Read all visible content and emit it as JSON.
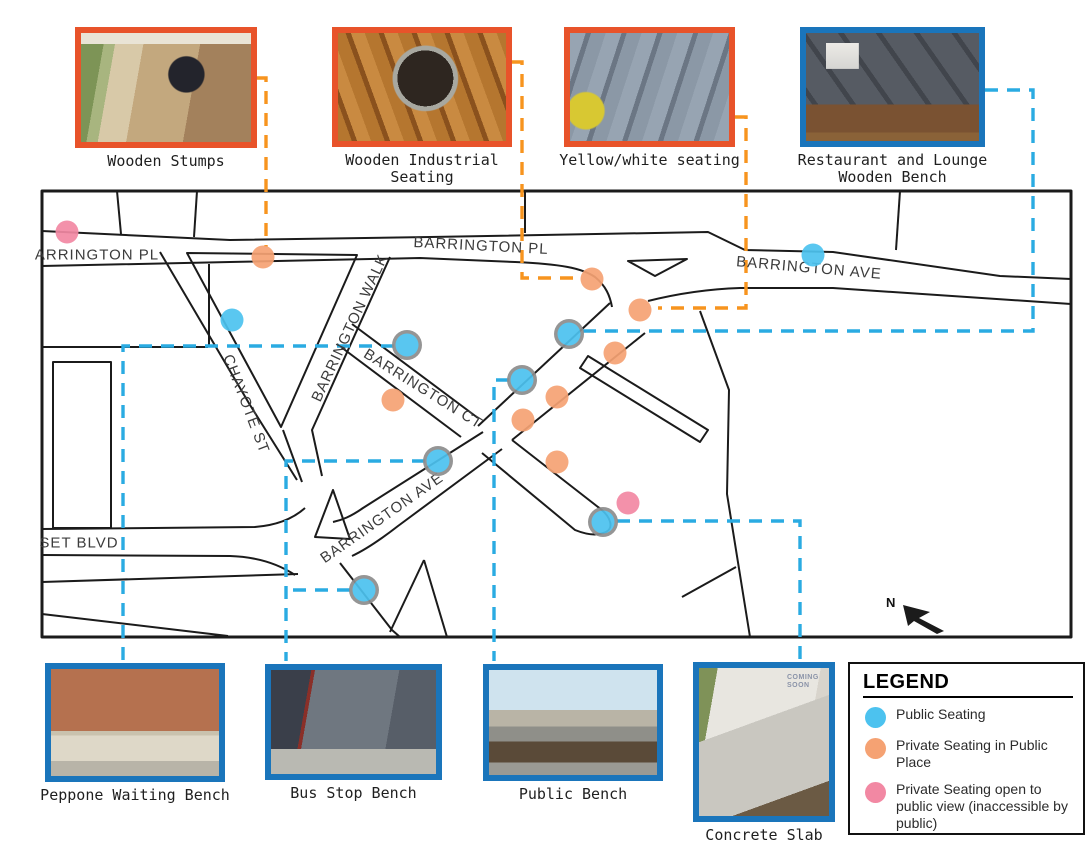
{
  "colors": {
    "road": "#1b1b1b",
    "ring": "#8d8d8d",
    "dash_orange": "#f7941e",
    "dash_blue": "#2aabe2",
    "frame_orange": "#e8532a",
    "frame_blue": "#1a75bb",
    "dot_blue": "#4cc2ef",
    "dot_orange": "#f5a273",
    "dot_pink": "#f288a3"
  },
  "top_photos": [
    {
      "label": "Wooden Stumps",
      "border": "orange"
    },
    {
      "label": "Wooden Industrial Seating",
      "border": "orange"
    },
    {
      "label": "Yellow/white seating",
      "border": "orange"
    },
    {
      "label": "Restaurant and Lounge Wooden Bench",
      "border": "blue"
    }
  ],
  "bottom_photos": [
    {
      "label": "Peppone Waiting Bench",
      "border": "blue"
    },
    {
      "label": "Bus Stop Bench",
      "border": "blue"
    },
    {
      "label": "Public Bench",
      "border": "blue"
    },
    {
      "label": "Concrete Slab",
      "border": "blue",
      "photo_text": "COMING SOON"
    }
  ],
  "map": {
    "north_label": "N",
    "streets": [
      {
        "name": "ARRINGTON PL",
        "x": 97,
        "y": 255,
        "rot": 0
      },
      {
        "name": "BARRINGTON PL",
        "x": 481,
        "y": 246,
        "rot": 3
      },
      {
        "name": "BARRINGTON AVE",
        "x": 809,
        "y": 268,
        "rot": 5
      },
      {
        "name": "BARRINGTON WALK",
        "x": 350,
        "y": 328,
        "rot": -65
      },
      {
        "name": "CHAYOTE ST",
        "x": 246,
        "y": 404,
        "rot": 69
      },
      {
        "name": "BARRINGTON CT",
        "x": 423,
        "y": 389,
        "rot": 32
      },
      {
        "name": "BARRINGTON AVE",
        "x": 382,
        "y": 518,
        "rot": -35
      },
      {
        "name": "SET BLVD",
        "x": 79,
        "y": 543,
        "rot": 0
      }
    ],
    "dots": [
      {
        "x": 67,
        "y": 232,
        "type": "pink",
        "ringed": false
      },
      {
        "x": 263,
        "y": 257,
        "type": "orange",
        "ringed": false
      },
      {
        "x": 232,
        "y": 320,
        "type": "blue",
        "ringed": false
      },
      {
        "x": 407,
        "y": 345,
        "type": "blue",
        "ringed": true
      },
      {
        "x": 813,
        "y": 255,
        "type": "blue",
        "ringed": false
      },
      {
        "x": 592,
        "y": 279,
        "type": "orange",
        "ringed": false
      },
      {
        "x": 640,
        "y": 310,
        "type": "orange",
        "ringed": false
      },
      {
        "x": 569,
        "y": 334,
        "type": "blue",
        "ringed": true
      },
      {
        "x": 615,
        "y": 353,
        "type": "orange",
        "ringed": false
      },
      {
        "x": 522,
        "y": 380,
        "type": "blue",
        "ringed": true
      },
      {
        "x": 557,
        "y": 397,
        "type": "orange",
        "ringed": false
      },
      {
        "x": 393,
        "y": 400,
        "type": "orange",
        "ringed": false
      },
      {
        "x": 523,
        "y": 420,
        "type": "orange",
        "ringed": false
      },
      {
        "x": 438,
        "y": 461,
        "type": "blue",
        "ringed": true
      },
      {
        "x": 557,
        "y": 462,
        "type": "orange",
        "ringed": false
      },
      {
        "x": 628,
        "y": 503,
        "type": "pink",
        "ringed": false
      },
      {
        "x": 603,
        "y": 522,
        "type": "blue",
        "ringed": true
      },
      {
        "x": 364,
        "y": 590,
        "type": "blue",
        "ringed": true
      }
    ]
  },
  "legend": {
    "title": "LEGEND",
    "items": [
      {
        "label": "Public Seating",
        "color": "#4cc2ef"
      },
      {
        "label": "Private Seating in Public Place",
        "color": "#f5a273"
      },
      {
        "label": "Private Seating open to public view (inaccessible by public)",
        "color": "#f288a3"
      }
    ]
  }
}
